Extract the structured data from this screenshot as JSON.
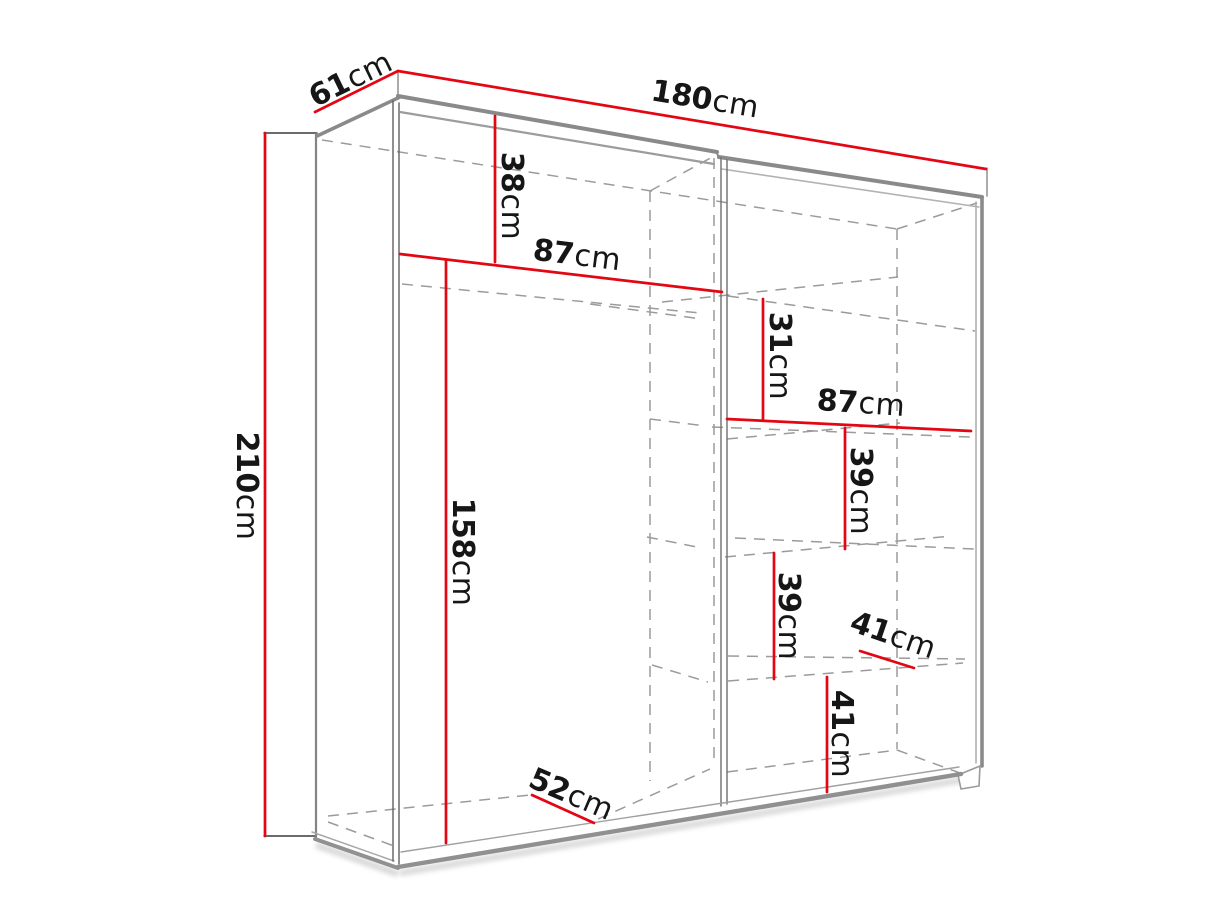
{
  "diagram": {
    "type": "furniture-dimension-line-drawing",
    "subject": "two-door sliding wardrobe with shelves, shown in perspective with hidden interior edges dashed",
    "accent_color": "#e30613",
    "structure_line_color": "#8a8a8a",
    "hidden_line_color": "#9b9b9b",
    "text_color": "#161616",
    "background_color": "#ffffff"
  },
  "dimensions": {
    "depth_total": {
      "value": "61",
      "unit": "cm"
    },
    "width_total": {
      "value": "180",
      "unit": "cm"
    },
    "height_total": {
      "value": "210",
      "unit": "cm"
    },
    "top_section_height": {
      "value": "38",
      "unit": "cm"
    },
    "left_section_width": {
      "value": "87",
      "unit": "cm"
    },
    "left_section_height": {
      "value": "158",
      "unit": "cm"
    },
    "right_top_gap_height": {
      "value": "31",
      "unit": "cm"
    },
    "right_section_width": {
      "value": "87",
      "unit": "cm"
    },
    "right_shelf_gap_upper": {
      "value": "39",
      "unit": "cm"
    },
    "right_shelf_gap_lower": {
      "value": "39",
      "unit": "cm"
    },
    "right_shelf_depth": {
      "value": "41",
      "unit": "cm"
    },
    "right_bottom_gap_height": {
      "value": "41",
      "unit": "cm"
    },
    "bottom_shelf_depth": {
      "value": "52",
      "unit": "cm"
    }
  }
}
